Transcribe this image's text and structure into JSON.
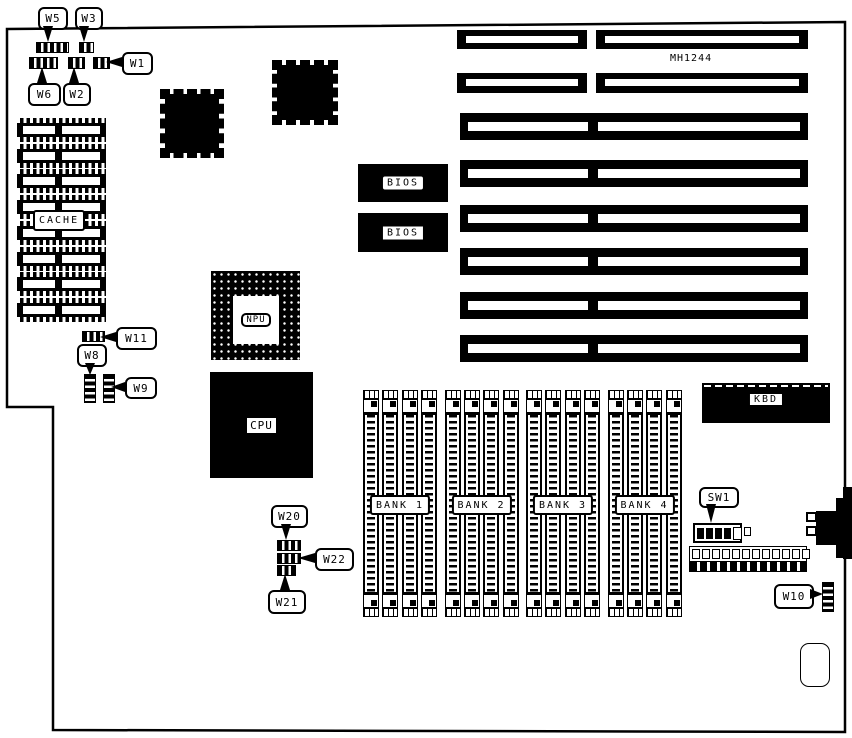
{
  "board": {
    "model": "MH1244",
    "component_labels": {
      "cache": "CACHE",
      "bios": [
        "BIOS",
        "BIOS"
      ],
      "npu": "NPU",
      "cpu": "CPU",
      "kbd": "KBD"
    },
    "bank_labels": [
      "BANK 1",
      "BANK 2",
      "BANK 3",
      "BANK 4"
    ],
    "callouts": [
      {
        "id": "w5",
        "label": "W5"
      },
      {
        "id": "w3",
        "label": "W3"
      },
      {
        "id": "w1",
        "label": "W1"
      },
      {
        "id": "w6",
        "label": "W6"
      },
      {
        "id": "w2",
        "label": "W2"
      },
      {
        "id": "w11",
        "label": "W11"
      },
      {
        "id": "w8",
        "label": "W8"
      },
      {
        "id": "w9",
        "label": "W9"
      },
      {
        "id": "w20",
        "label": "W20"
      },
      {
        "id": "w22",
        "label": "W22"
      },
      {
        "id": "w21",
        "label": "W21"
      },
      {
        "id": "w10",
        "label": "W10"
      },
      {
        "id": "sw1",
        "label": "SW1"
      }
    ],
    "counts": {
      "isa_slot_rows": 8,
      "cache_chips": 8,
      "memory_banks": 4,
      "sockets_per_bank": 4,
      "dip_switch_positions": 6,
      "header_positions": 12
    },
    "colors": {
      "ink": "#000000",
      "background": "#ffffff"
    }
  }
}
